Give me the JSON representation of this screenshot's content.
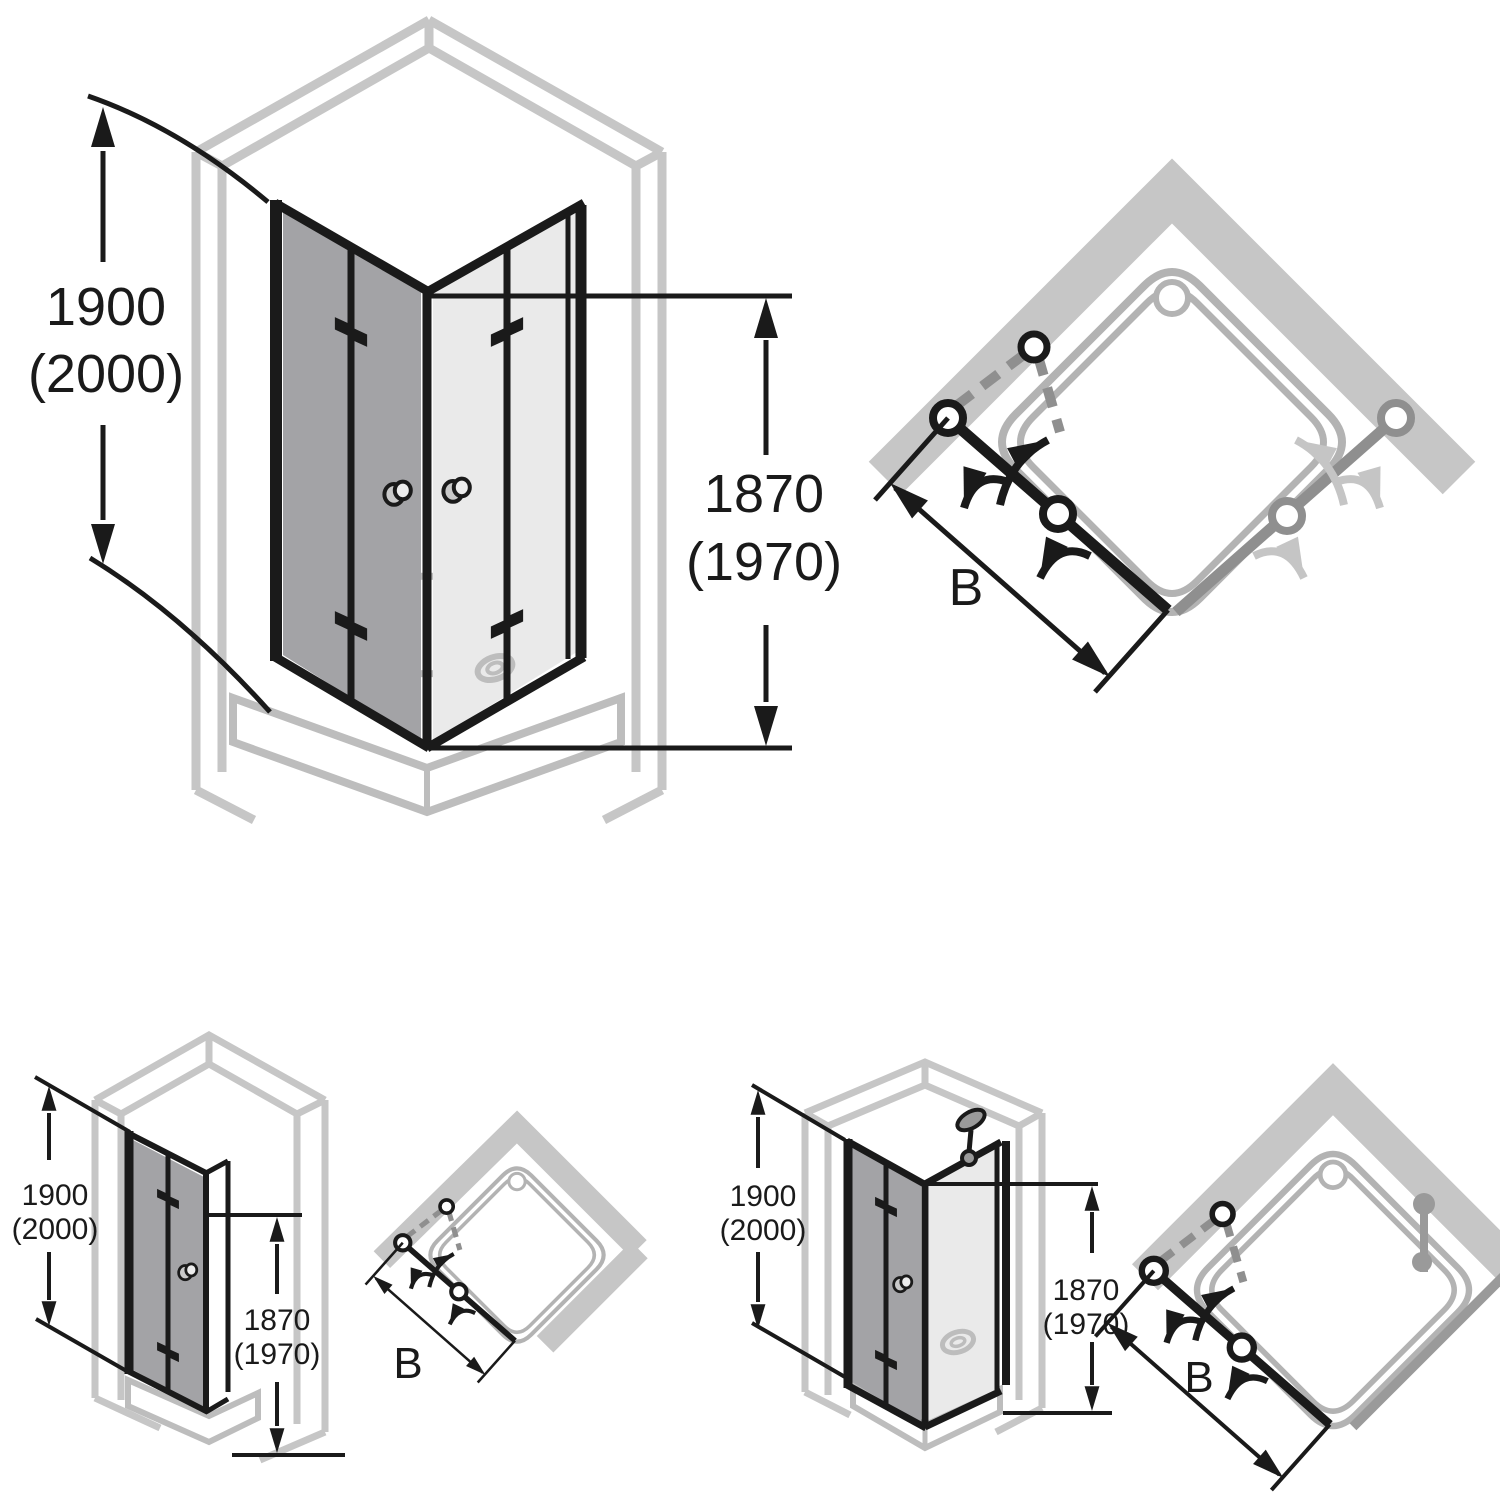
{
  "document": {
    "type": "technical-installation-drawing",
    "subject": "shower enclosure folding doors - elevation and plan views"
  },
  "colors": {
    "background": "#ffffff",
    "line_black": "#1a1a1a",
    "wall_gray": "#c6c6c6",
    "tray_gray": "#bdbdbd",
    "plan_tray_gray": "#b3b3b3",
    "glass_dark": "#a3a3a6",
    "glass_light": "#eaeaea",
    "door_gray": "#8f8f8f",
    "panel_gray": "#9a9a9a",
    "arrow_light_gray": "#c5c5c5"
  },
  "diagrams": {
    "corner_entry": {
      "title": "corner entry with two folding doors",
      "height_outer": "1900",
      "height_outer_alt": "(2000)",
      "height_door": "1870",
      "height_door_alt": "(1970)",
      "width_label": "B"
    },
    "niche_door": {
      "title": "folding door in niche",
      "height_outer": "1900",
      "height_outer_alt": "(2000)",
      "height_door": "1870",
      "height_door_alt": "(1970)",
      "width_label": "B"
    },
    "corner_door_side_panel": {
      "title": "folding door with side panel",
      "height_outer": "1900",
      "height_outer_alt": "(2000)",
      "height_door": "1870",
      "height_door_alt": "(1970)",
      "width_label": "B"
    }
  }
}
